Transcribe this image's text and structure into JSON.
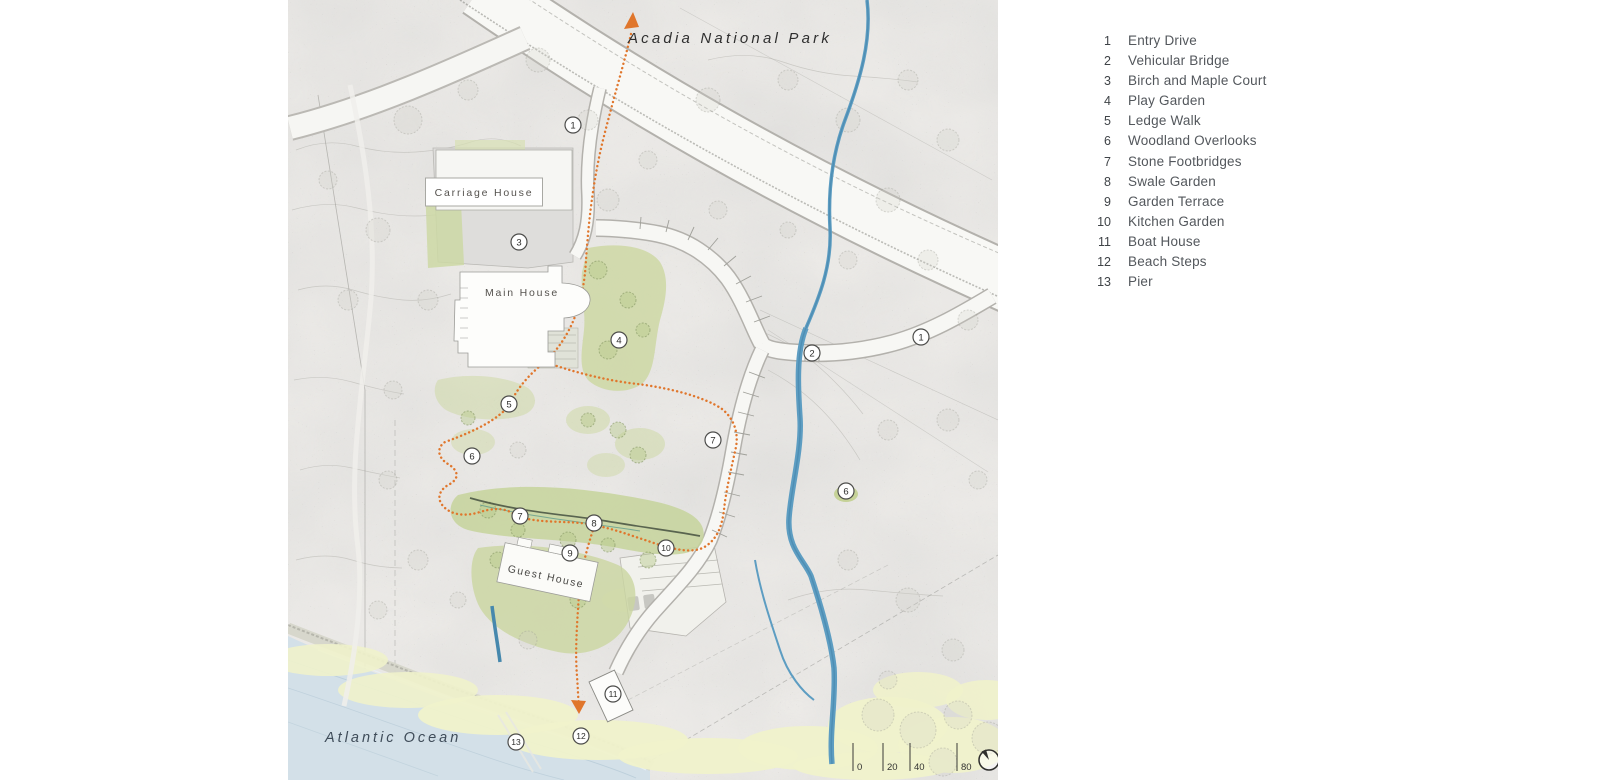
{
  "map": {
    "park_label": "Acadia National Park",
    "ocean_label": "Atlantic Ocean",
    "buildings": {
      "carriage": "Carriage House",
      "main": "Main House",
      "guest": "Guest House"
    },
    "scale": {
      "ticks": [
        "0",
        "20",
        "40",
        "80"
      ]
    },
    "colors": {
      "trail_orange": "#e0762c",
      "stream_blue": "#5d9dc2",
      "ocean_blue": "#d3e0e8",
      "garden_green": "#cbd69e",
      "shore_yellow": "#f0f2cb"
    },
    "markers": [
      {
        "label": "1",
        "name": "Entry Drive"
      },
      {
        "label": "3",
        "name": "Birch and Maple Court"
      },
      {
        "label": "4",
        "name": "Play Garden"
      },
      {
        "label": "2",
        "name": "Vehicular Bridge"
      },
      {
        "label": "1",
        "name": "Entry Drive"
      },
      {
        "label": "5",
        "name": "Ledge Walk"
      },
      {
        "label": "6",
        "name": "Woodland Overlooks"
      },
      {
        "label": "7",
        "name": "Stone Footbridges"
      },
      {
        "label": "6",
        "name": "Woodland Overlooks"
      },
      {
        "label": "7",
        "name": "Stone Footbridges"
      },
      {
        "label": "8",
        "name": "Swale Garden"
      },
      {
        "label": "9",
        "name": "Garden Terrace"
      },
      {
        "label": "10",
        "name": "Kitchen Garden"
      },
      {
        "label": "11",
        "name": "Boat House"
      },
      {
        "label": "12",
        "name": "Beach Steps"
      },
      {
        "label": "13",
        "name": "Pier"
      }
    ]
  },
  "legend": {
    "items": [
      {
        "num": "1",
        "label": "Entry Drive"
      },
      {
        "num": "2",
        "label": "Vehicular Bridge"
      },
      {
        "num": "3",
        "label": "Birch and Maple Court"
      },
      {
        "num": "4",
        "label": "Play Garden"
      },
      {
        "num": "5",
        "label": "Ledge Walk"
      },
      {
        "num": "6",
        "label": "Woodland Overlooks"
      },
      {
        "num": "7",
        "label": "Stone Footbridges"
      },
      {
        "num": "8",
        "label": "Swale Garden"
      },
      {
        "num": "9",
        "label": "Garden Terrace"
      },
      {
        "num": "10",
        "label": "Kitchen Garden"
      },
      {
        "num": "11",
        "label": "Boat House"
      },
      {
        "num": "12",
        "label": "Beach Steps"
      },
      {
        "num": "13",
        "label": "Pier"
      }
    ]
  }
}
